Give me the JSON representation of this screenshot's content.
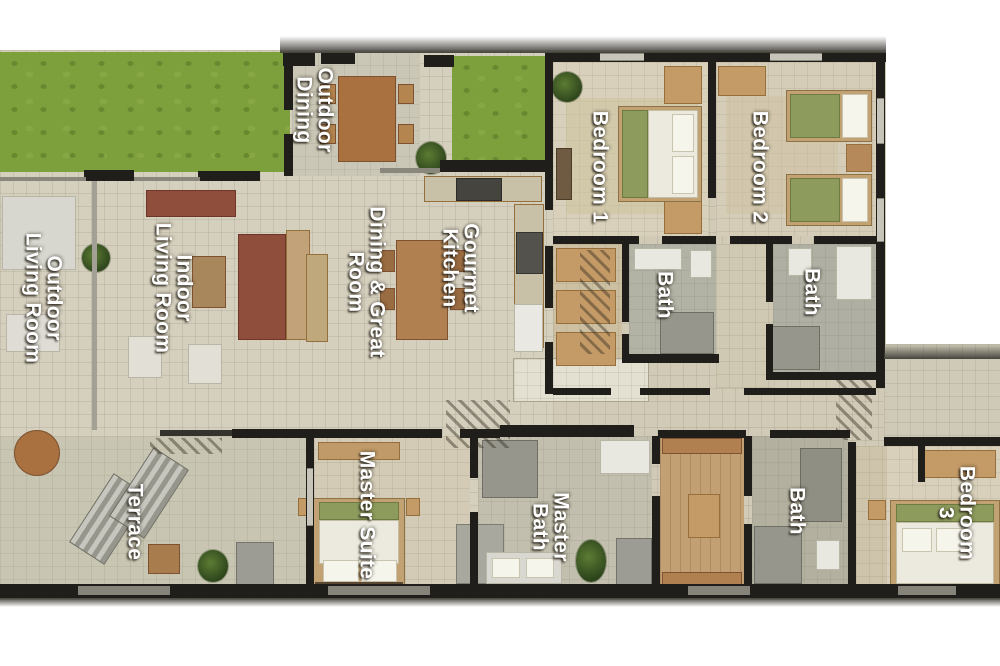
{
  "document": {
    "type": "residential-floor-plan-rendering",
    "background": "#ffffff"
  },
  "rooms": [
    {
      "id": "outdoor-dining",
      "label": "Outdoor\nDining"
    },
    {
      "id": "bedroom-1",
      "label": "Bedroom 1"
    },
    {
      "id": "bedroom-2",
      "label": "Bedroom 2"
    },
    {
      "id": "bath-bedroom-1",
      "label": "Bath"
    },
    {
      "id": "bath-bedroom-2",
      "label": "Bath"
    },
    {
      "id": "outdoor-living-room",
      "label": "Outdoor\nLiving Room"
    },
    {
      "id": "indoor-living-room",
      "label": "Indoor\nLiving Room"
    },
    {
      "id": "dining-great-room",
      "label": "Dining & Great\nRoom"
    },
    {
      "id": "gourmet-kitchen",
      "label": "Gourmet\nKitchen"
    },
    {
      "id": "master-suite",
      "label": "Master Suite"
    },
    {
      "id": "master-bath",
      "label": "Master\nBath"
    },
    {
      "id": "bath-3",
      "label": "Bath"
    },
    {
      "id": "bedroom-3",
      "label": "Bedroom 3"
    },
    {
      "id": "terrace",
      "label": "Terrace"
    }
  ],
  "palette": {
    "wall": "#201e1a",
    "grass": "#7d9f3c",
    "floor_light": "#d5cfbe",
    "floor_bedroom": "#d8d0ba",
    "bath_tile": "#b0b0a4",
    "closet_wood": "#c39f74",
    "bed_blanket": "#8d9c5d",
    "sofa_red": "#8f4d3c",
    "furniture_wood": "#a9713f",
    "label_text": "#ffffff"
  }
}
